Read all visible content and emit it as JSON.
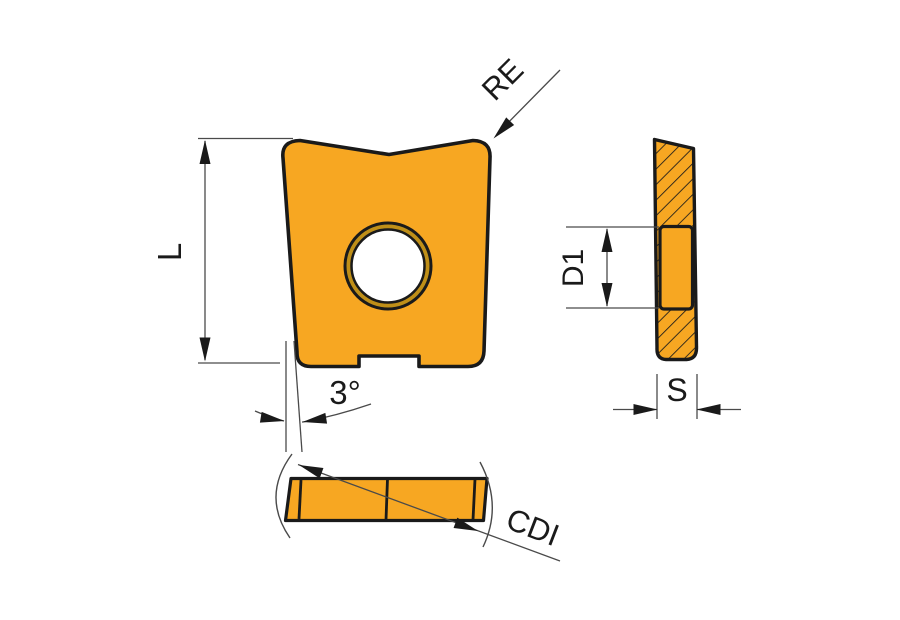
{
  "diagram": {
    "labels": {
      "corner_radius": "RE",
      "edge_length": "L",
      "taper_angle": "3°",
      "hole_diameter": "D1",
      "thickness": "S",
      "cutting_edge_diagonal": "CDI"
    },
    "colors": {
      "insert_fill": "#F7A722",
      "hole_ring_fill": "#BF8F18",
      "outline": "#1A1A1A",
      "dimension_line": "#4A4A4A",
      "background": "#FFFFFF"
    }
  }
}
